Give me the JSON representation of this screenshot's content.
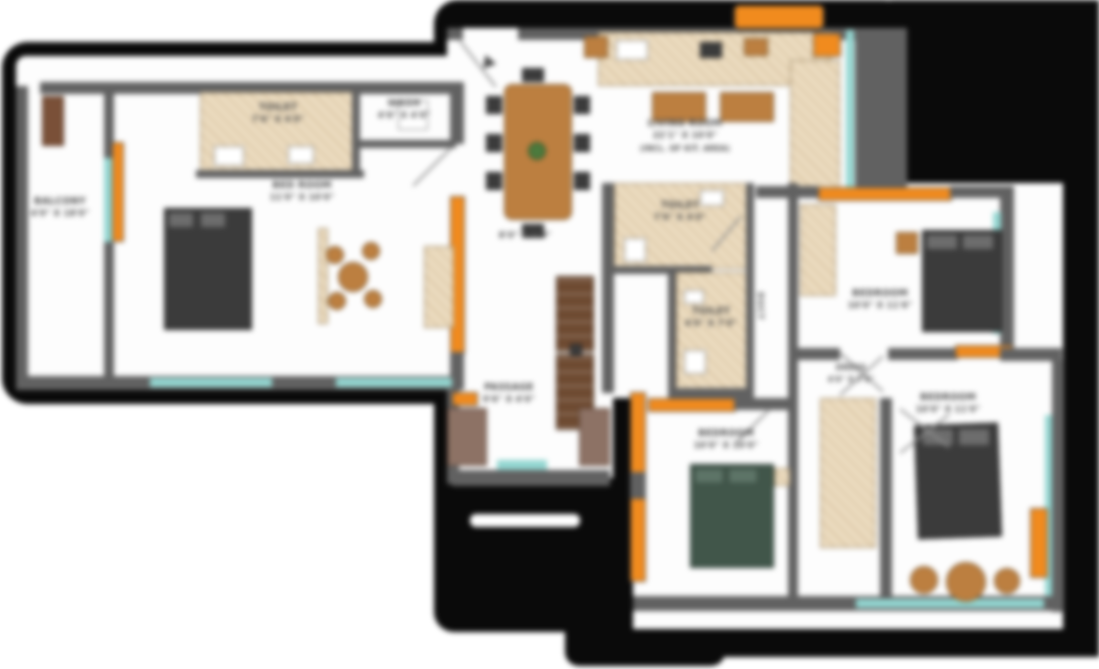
{
  "title": "apartment-floor-plan",
  "colors": {
    "accent_orange": "#f18b1e",
    "window_teal": "#93d6d1",
    "wall_gray": "#616161",
    "floor_beige": "#ecdcc0",
    "wood_brown": "#bc7f40",
    "bed_dark": "#3b3b3b",
    "outline_black": "#0a0a0a"
  },
  "rooms": {
    "balcony": {
      "name": "BALCONY",
      "dim": "4'0\" X 18'0\""
    },
    "toilet1": {
      "name": "TOILET",
      "dim": "7'6\" X 4'0\""
    },
    "wash": {
      "name": "WASH",
      "dim": "4'6\" X 4'0\""
    },
    "bedroom1": {
      "name": "BED ROOM",
      "dim": "11'0\" X 10'0\""
    },
    "living": {
      "name": "LIVING ROOM",
      "dim": "22'1\" X 10'0\"",
      "note": "(INCL. OF KIT. AREA)"
    },
    "foyer": {
      "dim": "8'0\" X 4'0\""
    },
    "passage": {
      "name": "PASSAGE",
      "dim": "9'6\" X 4'0\""
    },
    "toilet2": {
      "name": "TOILET",
      "dim": "7'0\" X 4'0\""
    },
    "toilet3": {
      "name": "TOILET",
      "dim": "4'0\" X 7'0\""
    },
    "duct": {
      "name": "DUCT"
    },
    "bedroom2": {
      "name": "BEDROOM",
      "dim": "10'0\" X 11'6\""
    },
    "dress": {
      "name": "DRESS",
      "dim": "4'0\" X 7'6\""
    },
    "bedroom3": {
      "name": "BEDROOM",
      "dim": "10'0\" X 10'0\""
    },
    "bedroom4": {
      "name": "BEDROOM",
      "dim": "10'0\" X 11'0\""
    }
  }
}
